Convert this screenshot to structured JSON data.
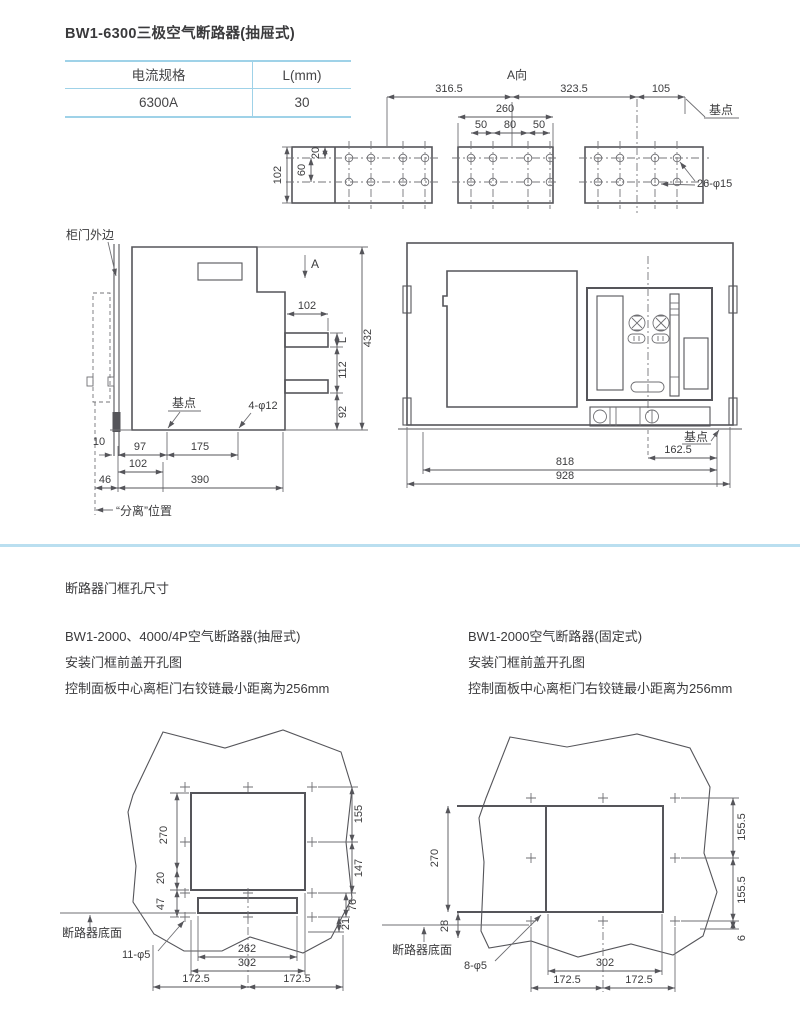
{
  "header": {
    "title": "BW1-6300三极空气断路器(抽屉式)"
  },
  "spec_table": {
    "col1_header": "电流规格",
    "col2_header": "L(mm)",
    "col1_value": "6300A",
    "col2_value": "30"
  },
  "a_view": {
    "label": "A向",
    "dim_316_5": "316.5",
    "dim_323_5": "323.5",
    "dim_105": "105",
    "base_point": "基点",
    "dim_260": "260",
    "dim_50_left": "50",
    "dim_80": "80",
    "dim_50_right": "50",
    "dim_102": "102",
    "dim_60": "60",
    "dim_20": "20",
    "holes": "26-φ15"
  },
  "side_view": {
    "door_edge_label": "柜门外边",
    "section_arrow": "A",
    "dim_102_top": "102",
    "dim_L": "L",
    "dim_432": "432",
    "dim_112": "112",
    "dim_92": "92",
    "base_point": "基点",
    "holes": "4-φ12",
    "dim_10": "10",
    "dim_97": "97",
    "dim_175": "175",
    "dim_102_bottom": "102",
    "dim_46": "46",
    "dim_390": "390",
    "separated_label": "“分离”位置"
  },
  "front_view": {
    "base_point": "基点",
    "dim_162_5": "162.5",
    "dim_818": "818",
    "dim_928": "928"
  },
  "door_section": {
    "title": "断路器门框孔尺寸",
    "left": {
      "line1": "BW1-2000、4000/4P空气断路器(抽屉式)",
      "line2": "安装门框前盖开孔图",
      "line3": "控制面板中心离柜门右铰链最小距离为256mm"
    },
    "right": {
      "line1": "BW1-2000空气断路器(固定式)",
      "line2": "安装门框前盖开孔图",
      "line3": "控制面板中心离柜门右铰链最小距离为256mm"
    }
  },
  "drawer_cutout": {
    "dim_270": "270",
    "dim_20": "20",
    "dim_47": "47",
    "dim_155": "155",
    "dim_147": "147",
    "dim_76": "76",
    "dim_21": "21",
    "dim_262": "262",
    "dim_302": "302",
    "dim_172_5_left": "172.5",
    "dim_172_5_right": "172.5",
    "holes": "11-φ5",
    "bottom_face": "断路器底面"
  },
  "fixed_cutout": {
    "dim_270": "270",
    "dim_155_5_top": "155.5",
    "dim_155_5_bottom": "155.5",
    "dim_28": "28",
    "dim_6": "6",
    "dim_302": "302",
    "dim_172_5_left": "172.5",
    "dim_172_5_right": "172.5",
    "holes": "8-φ5",
    "bottom_face": "断路器底面"
  },
  "colors": {
    "table_rule": "#9fd2e8",
    "divider": "#badff0",
    "line": "#55555a",
    "text": "#3c3c3e"
  }
}
